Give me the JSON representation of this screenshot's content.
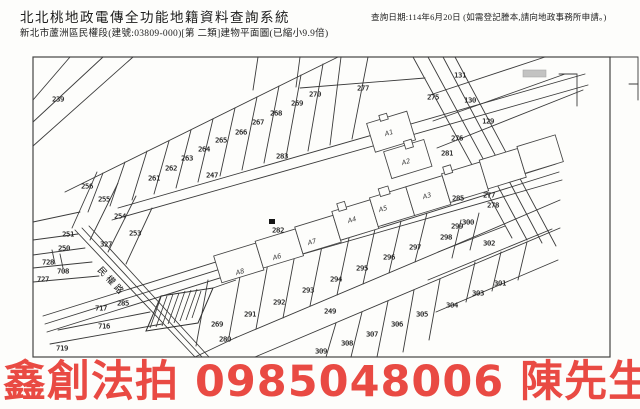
{
  "header": {
    "system_title": "北北桃地政電傳全功能地籍資料查詢系統",
    "subtitle": "新北市蘆洲區民權段(建號:03809-000)[第 二類]建物平面圖(已縮小9.9倍)",
    "query_date_note": "查詢日期:114年6月20日 (如需登記謄本,請向地政事務所申請。)"
  },
  "map": {
    "road_label": "民權路",
    "parcels": [
      {
        "id": "239",
        "x": 58,
        "y": 99
      },
      {
        "id": "247",
        "x": 212,
        "y": 175
      },
      {
        "id": "256",
        "x": 87,
        "y": 186
      },
      {
        "id": "255",
        "x": 104,
        "y": 199
      },
      {
        "id": "254",
        "x": 120,
        "y": 216
      },
      {
        "id": "253",
        "x": 135,
        "y": 233
      },
      {
        "id": "327",
        "x": 106,
        "y": 244
      },
      {
        "id": "251",
        "x": 68,
        "y": 234
      },
      {
        "id": "250",
        "x": 64,
        "y": 248
      },
      {
        "id": "728",
        "x": 48,
        "y": 262
      },
      {
        "id": "708",
        "x": 63,
        "y": 271
      },
      {
        "id": "727",
        "x": 43,
        "y": 279
      },
      {
        "id": "717",
        "x": 101,
        "y": 308
      },
      {
        "id": "716",
        "x": 104,
        "y": 326
      },
      {
        "id": "719",
        "x": 62,
        "y": 348
      },
      {
        "id": "261",
        "x": 154,
        "y": 178
      },
      {
        "id": "262",
        "x": 171,
        "y": 168
      },
      {
        "id": "263",
        "x": 187,
        "y": 158
      },
      {
        "id": "264",
        "x": 204,
        "y": 149
      },
      {
        "id": "265",
        "x": 221,
        "y": 140
      },
      {
        "id": "266",
        "x": 241,
        "y": 132
      },
      {
        "id": "267",
        "x": 258,
        "y": 122
      },
      {
        "id": "268",
        "x": 276,
        "y": 113
      },
      {
        "id": "269",
        "x": 297,
        "y": 103
      },
      {
        "id": "270",
        "x": 315,
        "y": 94
      },
      {
        "id": "277",
        "x": 363,
        "y": 88
      },
      {
        "id": "283",
        "x": 282,
        "y": 156
      },
      {
        "id": "131",
        "x": 460,
        "y": 75
      },
      {
        "id": "130",
        "x": 470,
        "y": 100
      },
      {
        "id": "129",
        "x": 488,
        "y": 121
      },
      {
        "id": "275",
        "x": 433,
        "y": 97
      },
      {
        "id": "276",
        "x": 457,
        "y": 138
      },
      {
        "id": "281",
        "x": 447,
        "y": 153
      },
      {
        "id": "277",
        "x": 489,
        "y": 195
      },
      {
        "id": "278",
        "x": 493,
        "y": 205
      },
      {
        "id": "285",
        "x": 123,
        "y": 303
      },
      {
        "id": "285",
        "x": 458,
        "y": 198
      },
      {
        "id": "282",
        "x": 278,
        "y": 230
      },
      {
        "id": "269",
        "x": 217,
        "y": 324
      },
      {
        "id": "280",
        "x": 225,
        "y": 339
      },
      {
        "id": "291",
        "x": 250,
        "y": 314
      },
      {
        "id": "292",
        "x": 279,
        "y": 302
      },
      {
        "id": "293",
        "x": 308,
        "y": 290
      },
      {
        "id": "294",
        "x": 336,
        "y": 279
      },
      {
        "id": "295",
        "x": 362,
        "y": 268
      },
      {
        "id": "296",
        "x": 389,
        "y": 257
      },
      {
        "id": "297",
        "x": 415,
        "y": 247
      },
      {
        "id": "249",
        "x": 330,
        "y": 311
      },
      {
        "id": "309",
        "x": 321,
        "y": 351
      },
      {
        "id": "308",
        "x": 347,
        "y": 343
      },
      {
        "id": "307",
        "x": 372,
        "y": 334
      },
      {
        "id": "306",
        "x": 397,
        "y": 324
      },
      {
        "id": "305",
        "x": 422,
        "y": 314
      },
      {
        "id": "298",
        "x": 446,
        "y": 237
      },
      {
        "id": "299",
        "x": 457,
        "y": 226
      },
      {
        "id": "300",
        "x": 468,
        "y": 222
      },
      {
        "id": "302",
        "x": 489,
        "y": 243
      },
      {
        "id": "301",
        "x": 500,
        "y": 283
      },
      {
        "id": "303",
        "x": 478,
        "y": 293
      },
      {
        "id": "304",
        "x": 452,
        "y": 305
      }
    ],
    "buildings": [
      {
        "id": "A1",
        "x": 389,
        "y": 133
      },
      {
        "id": "A2",
        "x": 406,
        "y": 162
      },
      {
        "id": "A3",
        "x": 427,
        "y": 196
      },
      {
        "id": "A4",
        "x": 352,
        "y": 220
      },
      {
        "id": "A5",
        "x": 383,
        "y": 209
      },
      {
        "id": "A6",
        "x": 277,
        "y": 257
      },
      {
        "id": "A7",
        "x": 312,
        "y": 242
      },
      {
        "id": "A8",
        "x": 240,
        "y": 272
      }
    ]
  },
  "watermark": {
    "text": "鑫創法拍 0985048006 陳先生",
    "color": "#e8413a"
  }
}
